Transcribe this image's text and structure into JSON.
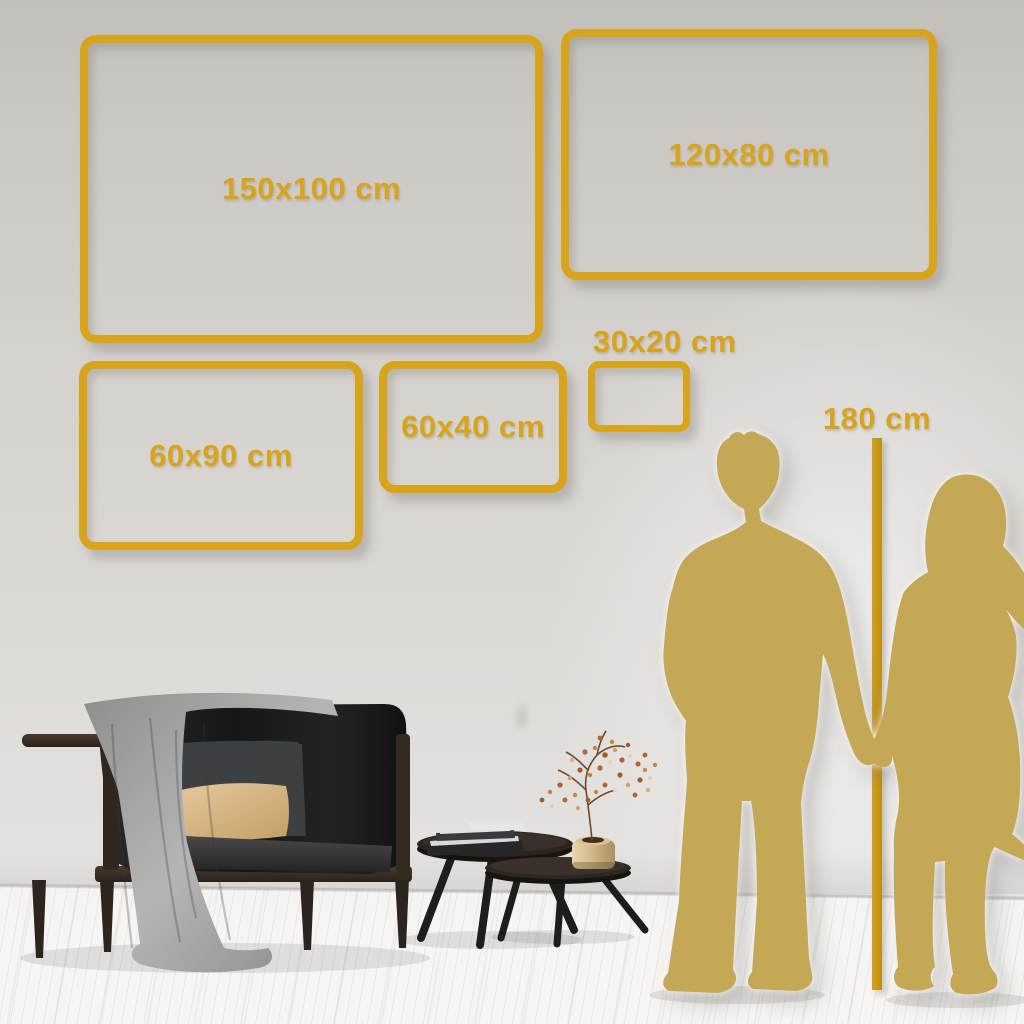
{
  "meta": {
    "description": "Wall-art size comparison guide: five gold frame outlines on a living-room wall with sofa, nesting coffee tables and a couple silhouette next to a 180 cm height ruler"
  },
  "frames": [
    {
      "name": "size-150x100",
      "label": "150x100 cm"
    },
    {
      "name": "size-120x80",
      "label": "120x80 cm"
    },
    {
      "name": "size-60x90",
      "label": "60x90 cm"
    },
    {
      "name": "size-60x40",
      "label": "60x40 cm"
    },
    {
      "name": "size-30x20",
      "label": "30x20 cm"
    }
  ],
  "height_reference": {
    "label": "180 cm"
  },
  "colors": {
    "frame_gold": "#D8A41C",
    "ruler_gold": "#C9991A",
    "silhouette_gold": "#C5A855",
    "wall_gray": "#D8D5D1",
    "floor_white": "#F3F2F0",
    "sofa_black": "#1C1C1C",
    "blanket_gray": "#9E9E9E",
    "pillow_tan": "#D9B988"
  },
  "scene_items": [
    "sofa",
    "blanket",
    "dark-pillow",
    "tan-pillow",
    "coffee-table-large",
    "coffee-table-small",
    "book-stack",
    "brass-vase",
    "dried-flower-branch",
    "man-silhouette",
    "woman-silhouette",
    "height-ruler"
  ]
}
